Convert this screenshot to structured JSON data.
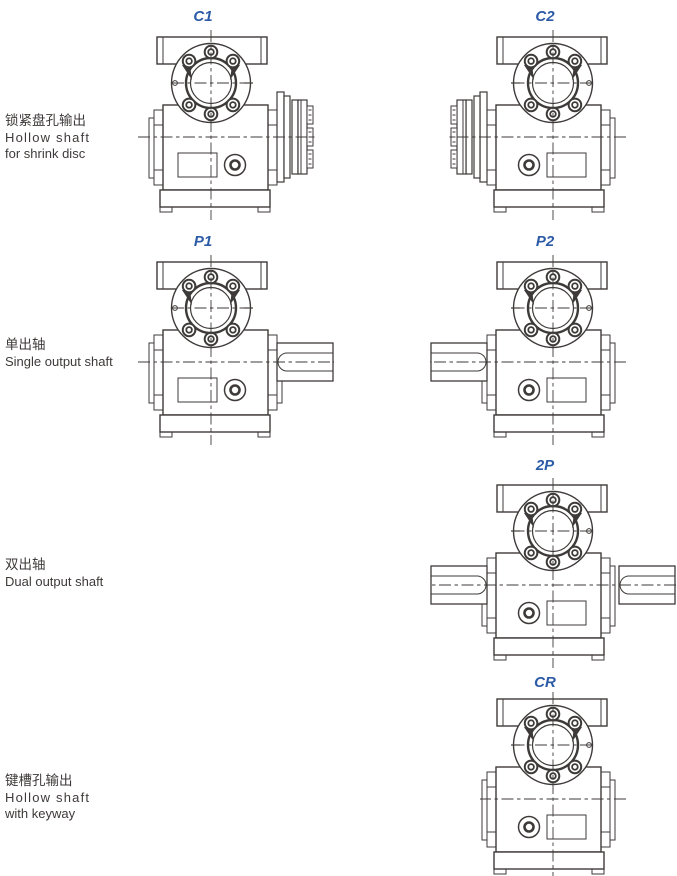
{
  "colors": {
    "line": "#3e3a39",
    "accent_blue": "#2b5aa6",
    "background": "#ffffff"
  },
  "rows": [
    {
      "label_zh": "锁紧盘孔输出",
      "label_en1": "Hollow shaft",
      "label_en2": "for shrink disc",
      "figures": [
        {
          "code": "C1",
          "output": "shrink-disc-right"
        },
        {
          "code": "C2",
          "output": "shrink-disc-left"
        }
      ]
    },
    {
      "label_zh": "单出轴",
      "label_en1": "Single output shaft",
      "label_en2": "",
      "figures": [
        {
          "code": "P1",
          "output": "shaft-right"
        },
        {
          "code": "P2",
          "output": "shaft-left"
        }
      ]
    },
    {
      "label_zh": "双出轴",
      "label_en1": "Dual output shaft",
      "label_en2": "",
      "figures": [
        {
          "code": "2P",
          "output": "shaft-both"
        }
      ]
    },
    {
      "label_zh": "键槽孔输出",
      "label_en1": "Hollow shaft",
      "label_en2": "with keyway",
      "figures": [
        {
          "code": "CR",
          "output": "hollow-keyway"
        }
      ]
    }
  ]
}
